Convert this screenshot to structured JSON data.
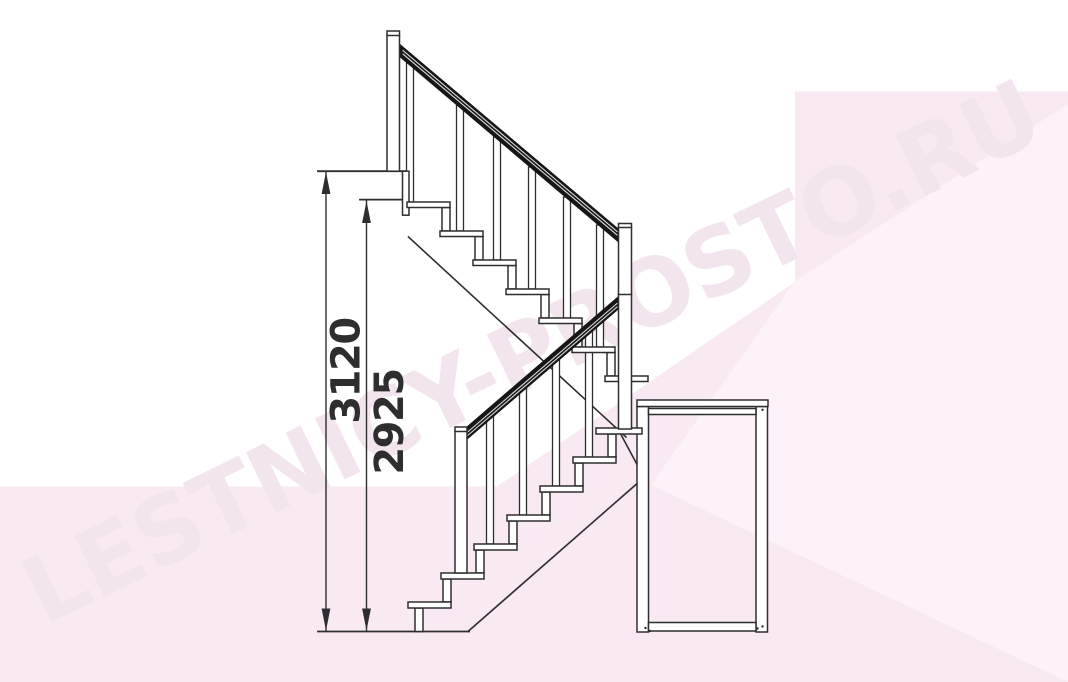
{
  "watermark": {
    "text": "LESTNICY-PROSTO.RU"
  },
  "dimensions": {
    "overall_height_label": "3120",
    "secondary_height_label": "2925"
  },
  "colors": {
    "background": "#ffffff",
    "pink_region": "#f9e9f3",
    "pink_light": "#fcf2f8",
    "watermark_text": "#f3e5ee",
    "line": "#2e2e2e",
    "rail": "#161616",
    "fill_white": "#ffffff"
  }
}
